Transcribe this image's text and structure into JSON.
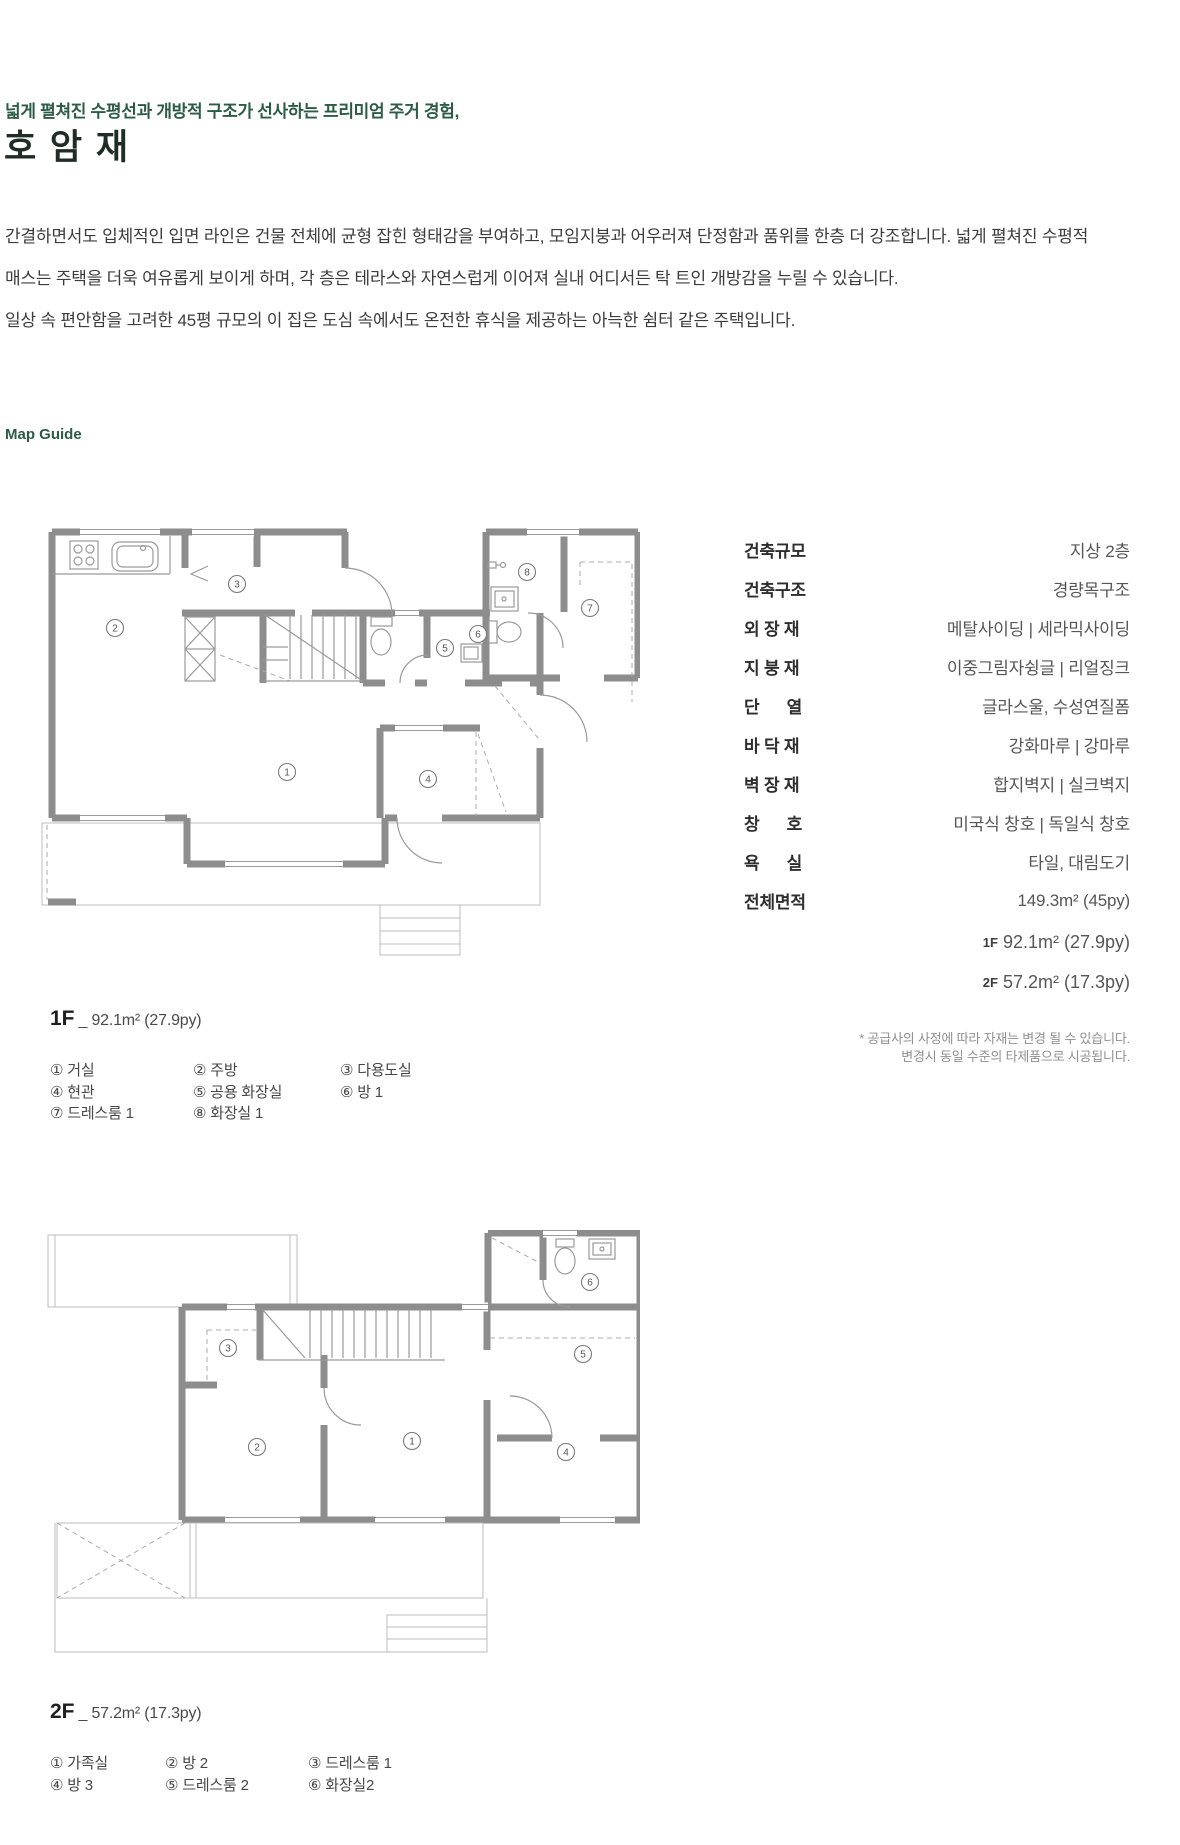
{
  "header": {
    "tagline": "넓게 펼쳐진 수평선과 개방적 구조가 선사하는 프리미엄 주거 경험,",
    "title": "호 암 재",
    "body_lines": [
      "간결하면서도 입체적인 입면 라인은 건물 전체에 균형 잡힌 형태감을 부여하고, 모임지붕과 어우러져 단정함과 품위를 한층 더 강조합니다. 넓게 펼쳐진 수평적",
      "매스는 주택을 더욱 여유롭게 보이게 하며, 각 층은 테라스와 자연스럽게 이어져 실내 어디서든 탁 트인 개방감을 누릴 수 있습니다.",
      "일상 속 편안함을 고려한 45평 규모의 이 집은 도심 속에서도 온전한 휴식을 제공하는 아늑한 쉼터 같은 주택입니다."
    ]
  },
  "map_guide_label": "Map Guide",
  "colors": {
    "accent_green": "#2d5c45",
    "wall_gray": "#8d8d8d"
  },
  "specs": {
    "rows": [
      {
        "label": "건축규모",
        "value": "지상 2층"
      },
      {
        "label": "건축구조",
        "value": "경량목구조"
      },
      {
        "label": "외 장 재",
        "value": "메탈사이딩 | 세라믹사이딩"
      },
      {
        "label": "지 붕 재",
        "value": "이중그림자슁글 | 리얼징크"
      },
      {
        "label": "단      열",
        "value": "글라스울, 수성연질폼"
      },
      {
        "label": "바 닥 재",
        "value": "강화마루 | 강마루"
      },
      {
        "label": "벽 장 재",
        "value": "합지벽지 | 실크벽지"
      },
      {
        "label": "창      호",
        "value": "미국식 창호 | 독일식 창호"
      },
      {
        "label": "욕      실",
        "value": "타일, 대림도기"
      },
      {
        "label": "전체면적",
        "value": "149.3m² (45py)"
      }
    ],
    "sub_rows": [
      {
        "label": "1F",
        "value": "92.1m² (27.9py)"
      },
      {
        "label": "2F",
        "value": "57.2m² (17.3py)"
      }
    ],
    "note_lines": [
      "* 공급사의 사정에 따라 자재는 변경 될 수 있습니다.",
      "변경시 동일 수준의 타제품으로 시공됩니다."
    ]
  },
  "floors": [
    {
      "id": "1f",
      "title": "1F",
      "area": "_ 92.1m² (27.9py)",
      "legend_rows": [
        [
          "① 거실",
          "② 주방",
          "③ 다용도실"
        ],
        [
          "④ 현관",
          "⑤ 공용 화장실",
          "⑥ 방 1"
        ],
        [
          "⑦ 드레스룸 1",
          "⑧ 화장실 1"
        ]
      ],
      "markers": [
        {
          "n": "①",
          "x": 247,
          "y": 322
        },
        {
          "n": "②",
          "x": 75,
          "y": 178
        },
        {
          "n": "③",
          "x": 197,
          "y": 134
        },
        {
          "n": "④",
          "x": 388,
          "y": 329
        },
        {
          "n": "⑤",
          "x": 405,
          "y": 198
        },
        {
          "n": "⑥",
          "x": 438,
          "y": 184
        },
        {
          "n": "⑦",
          "x": 550,
          "y": 158
        },
        {
          "n": "⑧",
          "x": 487,
          "y": 122
        }
      ]
    },
    {
      "id": "2f",
      "title": "2F",
      "area": "_ 57.2m² (17.3py)",
      "legend_rows": [
        [
          "① 가족실",
          "② 방 2",
          "③ 드레스룸 1"
        ],
        [
          "④ 방 3",
          "⑤ 드레스룸 2",
          "⑥ 화장실2"
        ]
      ],
      "markers": [
        {
          "n": "①",
          "x": 372,
          "y": 211
        },
        {
          "n": "②",
          "x": 217,
          "y": 217
        },
        {
          "n": "③",
          "x": 188,
          "y": 118
        },
        {
          "n": "④",
          "x": 526,
          "y": 222
        },
        {
          "n": "⑤",
          "x": 543,
          "y": 124
        },
        {
          "n": "⑥",
          "x": 550,
          "y": 52
        }
      ]
    }
  ]
}
